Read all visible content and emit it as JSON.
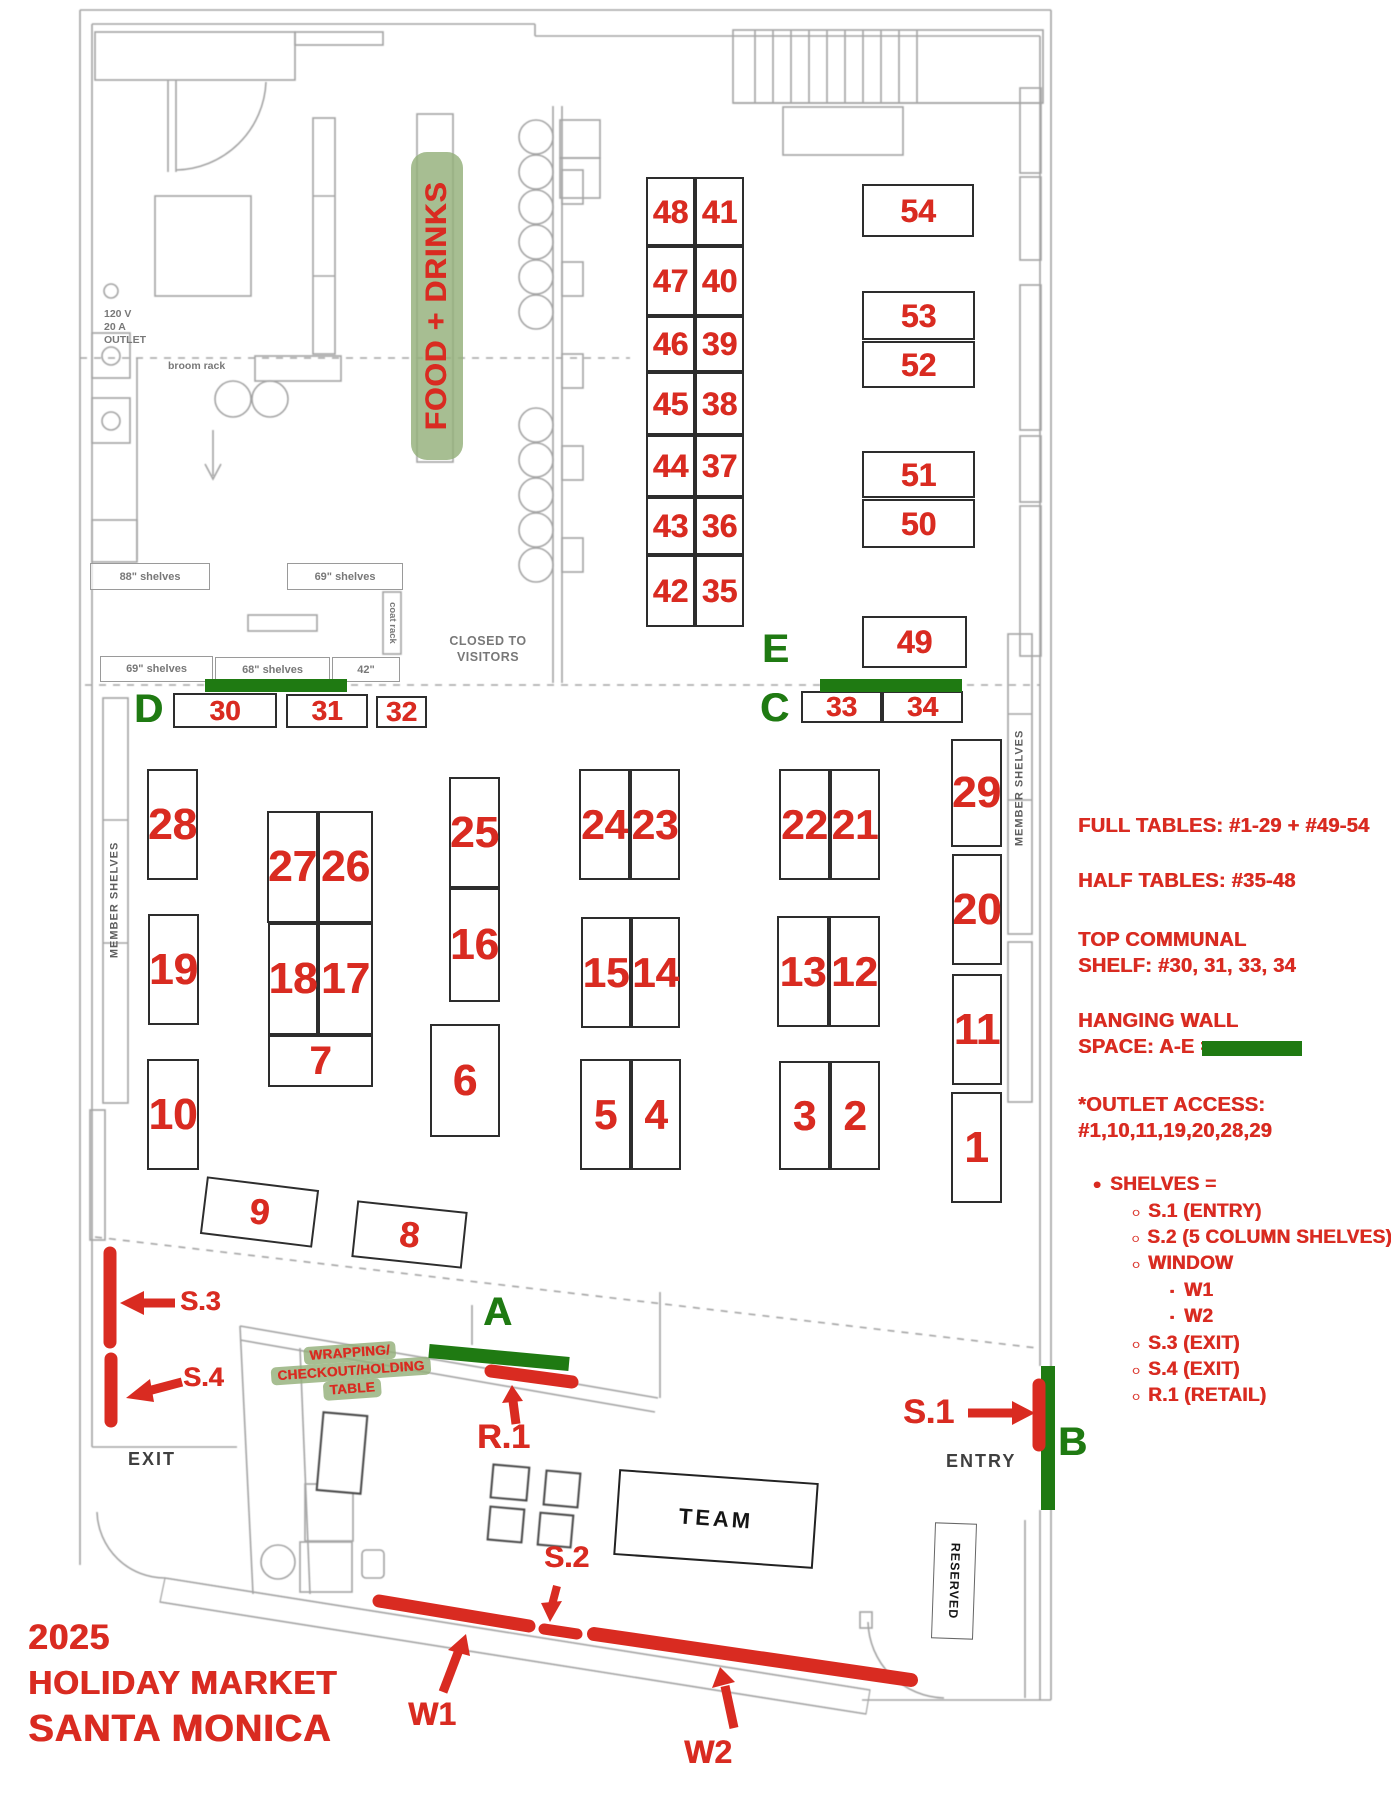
{
  "colors": {
    "red": "#d92b21",
    "green": "#1f7a12",
    "label_green_bg": "#94b07a"
  },
  "title": {
    "lines": [
      "2025",
      "HOLIDAY MARKET",
      "SANTA MONICA"
    ]
  },
  "legend": {
    "full_tables": "FULL TABLES: #1-29 + #49-54",
    "half_tables": "HALF TABLES: #35-48",
    "top_communal": [
      "TOP COMMUNAL",
      "SHELF: #30, 31, 33, 34"
    ],
    "hanging_wall": [
      "HANGING WALL",
      "SPACE: A-E ="
    ],
    "outlet_access": [
      "*OUTLET ACCESS:",
      "#1,10,11,19,20,28,29"
    ],
    "shelves_header": "SHELVES =",
    "shelves_items": [
      {
        "label": "S.1 (ENTRY)"
      },
      {
        "label": "S.2 (5 COLUMN SHELVES)"
      },
      {
        "label": "WINDOW",
        "children": [
          "W1",
          "W2"
        ]
      },
      {
        "label": "S.3 (EXIT)"
      },
      {
        "label": "S.4 (EXIT)"
      },
      {
        "label": "R.1 (RETAIL)"
      }
    ]
  },
  "markers": {
    "s1": "S.1",
    "s2": "S.2",
    "s3": "S.3",
    "s4": "S.4",
    "r1": "R.1",
    "w1": "W1",
    "w2": "W2"
  },
  "wall_letters": [
    {
      "label": "A",
      "x": 483,
      "y": 1292,
      "fs": 40
    },
    {
      "label": "B",
      "x": 1058,
      "y": 1422,
      "fs": 40
    },
    {
      "label": "C",
      "x": 760,
      "y": 688,
      "fs": 40
    },
    {
      "label": "D",
      "x": 134,
      "y": 689,
      "fs": 40
    },
    {
      "label": "E",
      "x": 762,
      "y": 629,
      "fs": 40
    }
  ],
  "food_drinks_label": "FOOD + DRINKS",
  "wrapping_label": [
    "WRAPPING/",
    "CHECKOUT/HOLDING",
    "TABLE"
  ],
  "plan_text": {
    "exit": "EXIT",
    "entry": "ENTRY",
    "team": "TEAM",
    "reserved": "RESERVED",
    "closed": [
      "CLOSED TO",
      "VISITORS"
    ],
    "outlet": [
      "120 V",
      "20 A",
      "OUTLET"
    ],
    "broom_rack": "broom rack",
    "coat_rack": "coat rack",
    "member_shelves": "MEMBER SHELVES"
  },
  "shelf_boxes": [
    {
      "text": "88\" shelves",
      "x": 90,
      "y": 563,
      "w": 120,
      "h": 27
    },
    {
      "text": "69\" shelves",
      "x": 287,
      "y": 563,
      "w": 116,
      "h": 27
    },
    {
      "text": "69\" shelves",
      "x": 100,
      "y": 656,
      "w": 113,
      "h": 26
    },
    {
      "text": "68\" shelves",
      "x": 215,
      "y": 657,
      "w": 115,
      "h": 25
    },
    {
      "text": "42\"",
      "x": 332,
      "y": 657,
      "w": 68,
      "h": 25
    }
  ],
  "tables": [
    {
      "n": "28",
      "x": 147,
      "y": 769,
      "w": 51,
      "h": 111,
      "fs": 44
    },
    {
      "n": "19",
      "x": 148,
      "y": 914,
      "w": 51,
      "h": 111,
      "fs": 44
    },
    {
      "n": "10",
      "x": 147,
      "y": 1059,
      "w": 52,
      "h": 111,
      "fs": 44
    },
    {
      "n": "27",
      "x": 267,
      "y": 811,
      "w": 51,
      "h": 112,
      "fs": 44
    },
    {
      "n": "26",
      "x": 318,
      "y": 811,
      "w": 55,
      "h": 112,
      "fs": 44
    },
    {
      "n": "18",
      "x": 268,
      "y": 923,
      "w": 50,
      "h": 112,
      "fs": 44
    },
    {
      "n": "17",
      "x": 318,
      "y": 923,
      "w": 55,
      "h": 112,
      "fs": 44
    },
    {
      "n": "7",
      "x": 268,
      "y": 1035,
      "w": 105,
      "h": 52,
      "fs": 40
    },
    {
      "n": "25",
      "x": 449,
      "y": 777,
      "w": 51,
      "h": 111,
      "fs": 44
    },
    {
      "n": "16",
      "x": 449,
      "y": 888,
      "w": 51,
      "h": 114,
      "fs": 44
    },
    {
      "n": "6",
      "x": 430,
      "y": 1024,
      "w": 70,
      "h": 113,
      "fs": 44
    },
    {
      "n": "24",
      "x": 579,
      "y": 769,
      "w": 51,
      "h": 111,
      "fs": 42
    },
    {
      "n": "23",
      "x": 630,
      "y": 769,
      "w": 50,
      "h": 111,
      "fs": 42
    },
    {
      "n": "15",
      "x": 581,
      "y": 917,
      "w": 50,
      "h": 111,
      "fs": 42
    },
    {
      "n": "14",
      "x": 631,
      "y": 917,
      "w": 49,
      "h": 111,
      "fs": 42
    },
    {
      "n": "5",
      "x": 580,
      "y": 1059,
      "w": 51,
      "h": 111,
      "fs": 42
    },
    {
      "n": "4",
      "x": 631,
      "y": 1059,
      "w": 50,
      "h": 111,
      "fs": 42
    },
    {
      "n": "22",
      "x": 779,
      "y": 769,
      "w": 51,
      "h": 111,
      "fs": 42
    },
    {
      "n": "21",
      "x": 830,
      "y": 769,
      "w": 50,
      "h": 111,
      "fs": 42
    },
    {
      "n": "13",
      "x": 777,
      "y": 916,
      "w": 52,
      "h": 111,
      "fs": 42
    },
    {
      "n": "12",
      "x": 829,
      "y": 916,
      "w": 51,
      "h": 111,
      "fs": 42
    },
    {
      "n": "3",
      "x": 779,
      "y": 1061,
      "w": 51,
      "h": 109,
      "fs": 42
    },
    {
      "n": "2",
      "x": 830,
      "y": 1061,
      "w": 50,
      "h": 109,
      "fs": 42
    },
    {
      "n": "29",
      "x": 951,
      "y": 739,
      "w": 51,
      "h": 108,
      "fs": 44
    },
    {
      "n": "20",
      "x": 952,
      "y": 854,
      "w": 50,
      "h": 111,
      "fs": 44
    },
    {
      "n": "11",
      "x": 952,
      "y": 974,
      "w": 50,
      "h": 111,
      "fs": 44
    },
    {
      "n": "1",
      "x": 951,
      "y": 1092,
      "w": 51,
      "h": 111,
      "fs": 44
    },
    {
      "n": "9",
      "x": 203,
      "y": 1183,
      "w": 113,
      "h": 58,
      "fs": 36,
      "rot": 7
    },
    {
      "n": "8",
      "x": 354,
      "y": 1206,
      "w": 111,
      "h": 57,
      "fs": 36,
      "rot": 6
    },
    {
      "n": "48",
      "x": 646,
      "y": 177,
      "w": 49,
      "h": 69,
      "fs": 32
    },
    {
      "n": "41",
      "x": 695,
      "y": 177,
      "w": 49,
      "h": 69,
      "fs": 32
    },
    {
      "n": "47",
      "x": 646,
      "y": 246,
      "w": 49,
      "h": 70,
      "fs": 32
    },
    {
      "n": "40",
      "x": 695,
      "y": 246,
      "w": 49,
      "h": 70,
      "fs": 32
    },
    {
      "n": "46",
      "x": 646,
      "y": 316,
      "w": 49,
      "h": 56,
      "fs": 32
    },
    {
      "n": "39",
      "x": 695,
      "y": 316,
      "w": 49,
      "h": 56,
      "fs": 32
    },
    {
      "n": "45",
      "x": 646,
      "y": 372,
      "w": 49,
      "h": 63,
      "fs": 32
    },
    {
      "n": "38",
      "x": 695,
      "y": 372,
      "w": 49,
      "h": 63,
      "fs": 32
    },
    {
      "n": "44",
      "x": 646,
      "y": 435,
      "w": 49,
      "h": 62,
      "fs": 32
    },
    {
      "n": "37",
      "x": 695,
      "y": 435,
      "w": 49,
      "h": 62,
      "fs": 32
    },
    {
      "n": "43",
      "x": 646,
      "y": 497,
      "w": 49,
      "h": 58,
      "fs": 32
    },
    {
      "n": "36",
      "x": 695,
      "y": 497,
      "w": 49,
      "h": 58,
      "fs": 32
    },
    {
      "n": "42",
      "x": 646,
      "y": 555,
      "w": 49,
      "h": 72,
      "fs": 32
    },
    {
      "n": "35",
      "x": 695,
      "y": 555,
      "w": 49,
      "h": 72,
      "fs": 32
    },
    {
      "n": "54",
      "x": 862,
      "y": 184,
      "w": 112,
      "h": 53,
      "fs": 32
    },
    {
      "n": "53",
      "x": 862,
      "y": 291,
      "w": 113,
      "h": 49,
      "fs": 32
    },
    {
      "n": "52",
      "x": 862,
      "y": 341,
      "w": 113,
      "h": 47,
      "fs": 32
    },
    {
      "n": "51",
      "x": 862,
      "y": 451,
      "w": 113,
      "h": 47,
      "fs": 32
    },
    {
      "n": "50",
      "x": 862,
      "y": 499,
      "w": 113,
      "h": 49,
      "fs": 32
    },
    {
      "n": "49",
      "x": 862,
      "y": 616,
      "w": 105,
      "h": 52,
      "fs": 32
    },
    {
      "n": "30",
      "x": 173,
      "y": 693,
      "w": 104,
      "h": 35,
      "fs": 28
    },
    {
      "n": "31",
      "x": 286,
      "y": 694,
      "w": 82,
      "h": 34,
      "fs": 28
    },
    {
      "n": "32",
      "x": 376,
      "y": 696,
      "w": 51,
      "h": 32,
      "fs": 28
    },
    {
      "n": "33",
      "x": 801,
      "y": 691,
      "w": 81,
      "h": 32,
      "fs": 28
    },
    {
      "n": "34",
      "x": 882,
      "y": 691,
      "w": 81,
      "h": 32,
      "fs": 28
    }
  ]
}
